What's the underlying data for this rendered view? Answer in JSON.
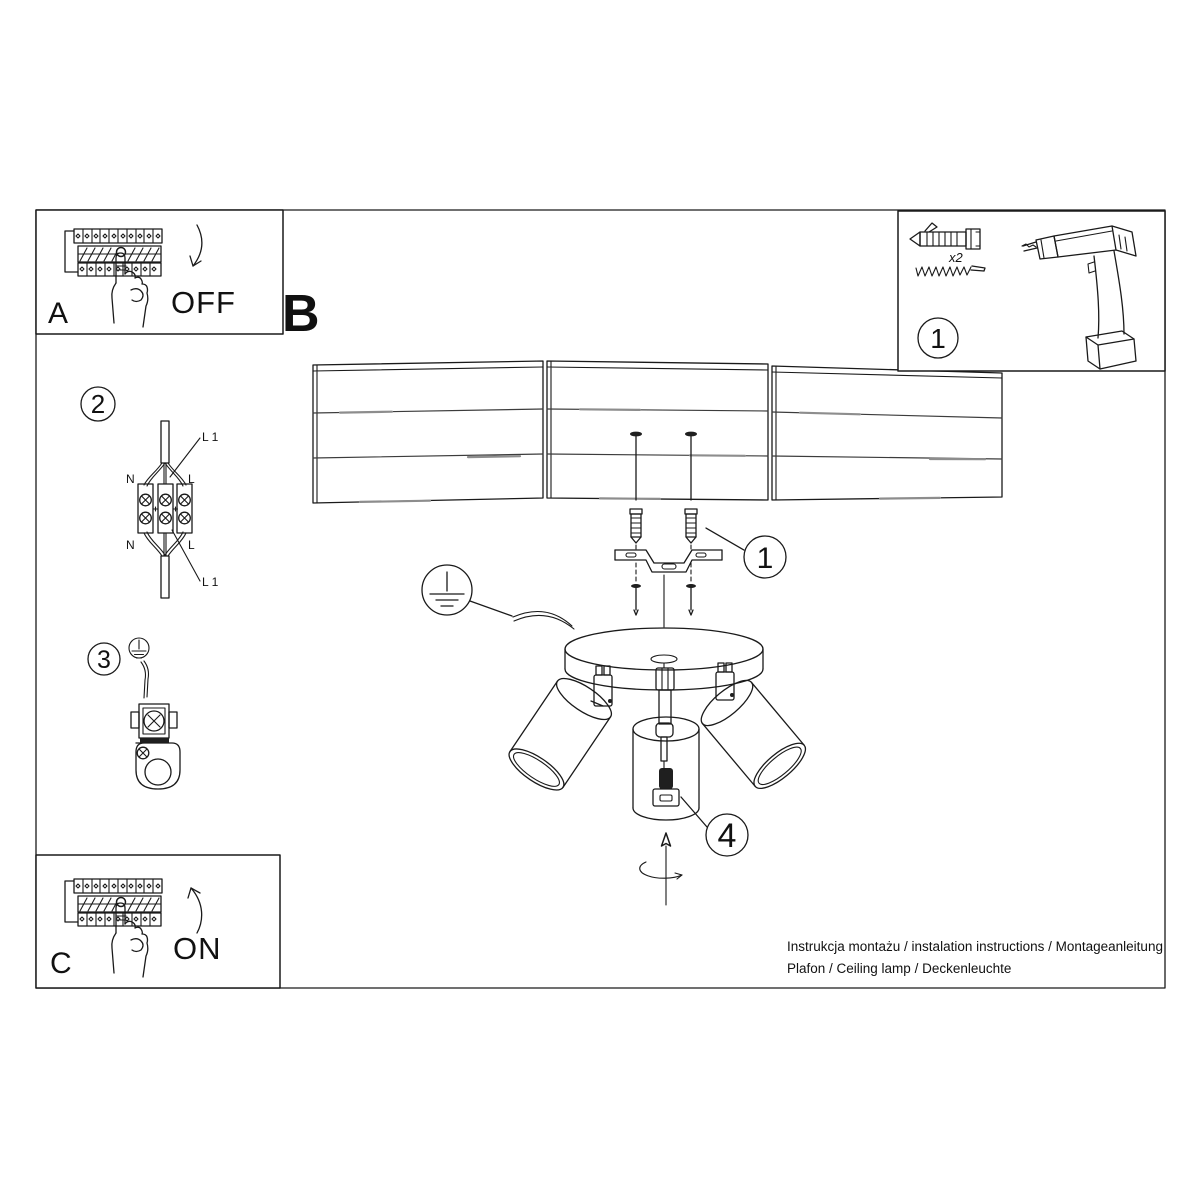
{
  "colors": {
    "background": "#ffffff",
    "line": "#1a1a1a"
  },
  "boxes": {
    "a": {
      "label": "A",
      "action": "OFF"
    },
    "c": {
      "label": "C",
      "action": "ON"
    },
    "parts": {
      "step": "1",
      "screw_count": "x2"
    }
  },
  "section_b": {
    "label": "B"
  },
  "callouts": {
    "bracket": "1",
    "wiring": "2",
    "ground": "3",
    "bulb": "4"
  },
  "wiring_labels": {
    "l1_top": "L 1",
    "neutral_top": "N",
    "live_top": "L",
    "l1_bottom": "L 1",
    "neutral_bottom": "N",
    "live_bottom": "L"
  },
  "footer": {
    "line1": "Instrukcja montażu / instalation instructions / Montageanleitung",
    "line2": "Plafon / Ceiling lamp / Deckenleuchte"
  }
}
